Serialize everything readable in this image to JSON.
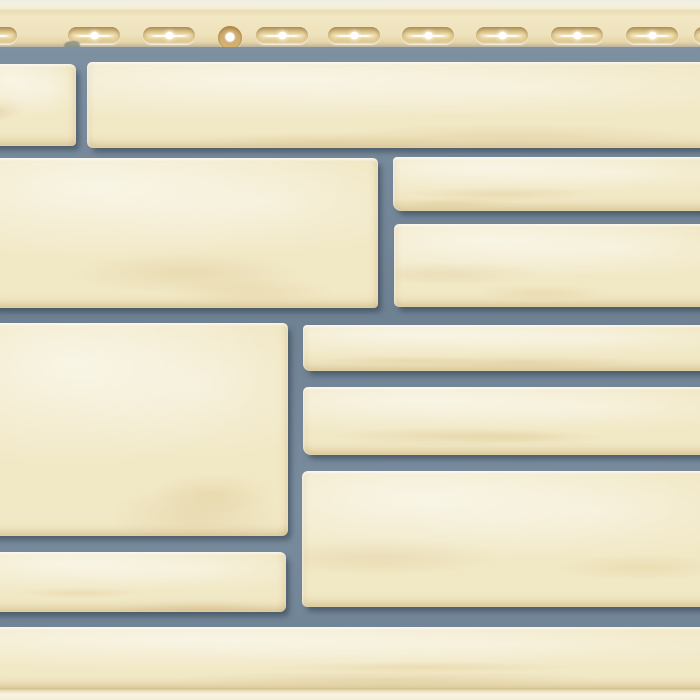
{
  "scene": {
    "title": "Facade panel — sand-colored rough-cut stone pattern",
    "description": "Product photo of a vinyl facade cladding panel imitating cream sandstone blocks of varying sizes set in grey mortar joints, with a perforated nailing hem of oval fastening slots and one round nail hole along the top edge, and a light locking strip along the bottom edge.",
    "visible_text": []
  },
  "palette": {
    "stone_base": "#f1e8c5",
    "stone_highlight": "#faf4de",
    "stone_stain": "#cfa96b",
    "mortar": "#74889a",
    "mortar_shadow": "#3f5365",
    "strip_base": "#efe3bd",
    "strip_top": "#f5efda",
    "slot_fill": "#e7d199",
    "slot_rim": "#c3ab74",
    "nail_hole": "#d7b474",
    "perforation_glow": "#ffffff",
    "bottom_edge": "#f8f3e1",
    "bottom_edge_line": "#cdbc8a"
  },
  "nailing_strip": {
    "height": 47,
    "slot_width": 52,
    "slot_height": 17,
    "slot_top": 27,
    "slot_x": [
      -35,
      68,
      143,
      256,
      328,
      402,
      476,
      551,
      626,
      694
    ],
    "nail_hole": {
      "x": 218,
      "y": 26,
      "diameter": 24
    },
    "blemish": {
      "x": 64,
      "y": 41,
      "w": 16,
      "h": 9
    }
  },
  "masonry": {
    "joint_width": 15,
    "stones": [
      {
        "id": "A1",
        "x": -14,
        "y": 64,
        "w": 90,
        "h": 82
      },
      {
        "id": "A2",
        "x": 87,
        "y": 62,
        "w": 626,
        "h": 86
      },
      {
        "id": "B1",
        "x": -12,
        "y": 158,
        "w": 390,
        "h": 150
      },
      {
        "id": "B2",
        "x": 393,
        "y": 157,
        "w": 322,
        "h": 54
      },
      {
        "id": "B3",
        "x": 394,
        "y": 224,
        "w": 322,
        "h": 83
      },
      {
        "id": "C0",
        "x": -12,
        "y": 323,
        "w": 300,
        "h": 213
      },
      {
        "id": "C1",
        "x": 303,
        "y": 325,
        "w": 412,
        "h": 46
      },
      {
        "id": "C2",
        "x": 303,
        "y": 387,
        "w": 412,
        "h": 68
      },
      {
        "id": "C3",
        "x": 302,
        "y": 471,
        "w": 414,
        "h": 136
      },
      {
        "id": "D1",
        "x": -12,
        "y": 552,
        "w": 298,
        "h": 60
      },
      {
        "id": "E1",
        "x": -12,
        "y": 627,
        "w": 726,
        "h": 62
      }
    ]
  }
}
